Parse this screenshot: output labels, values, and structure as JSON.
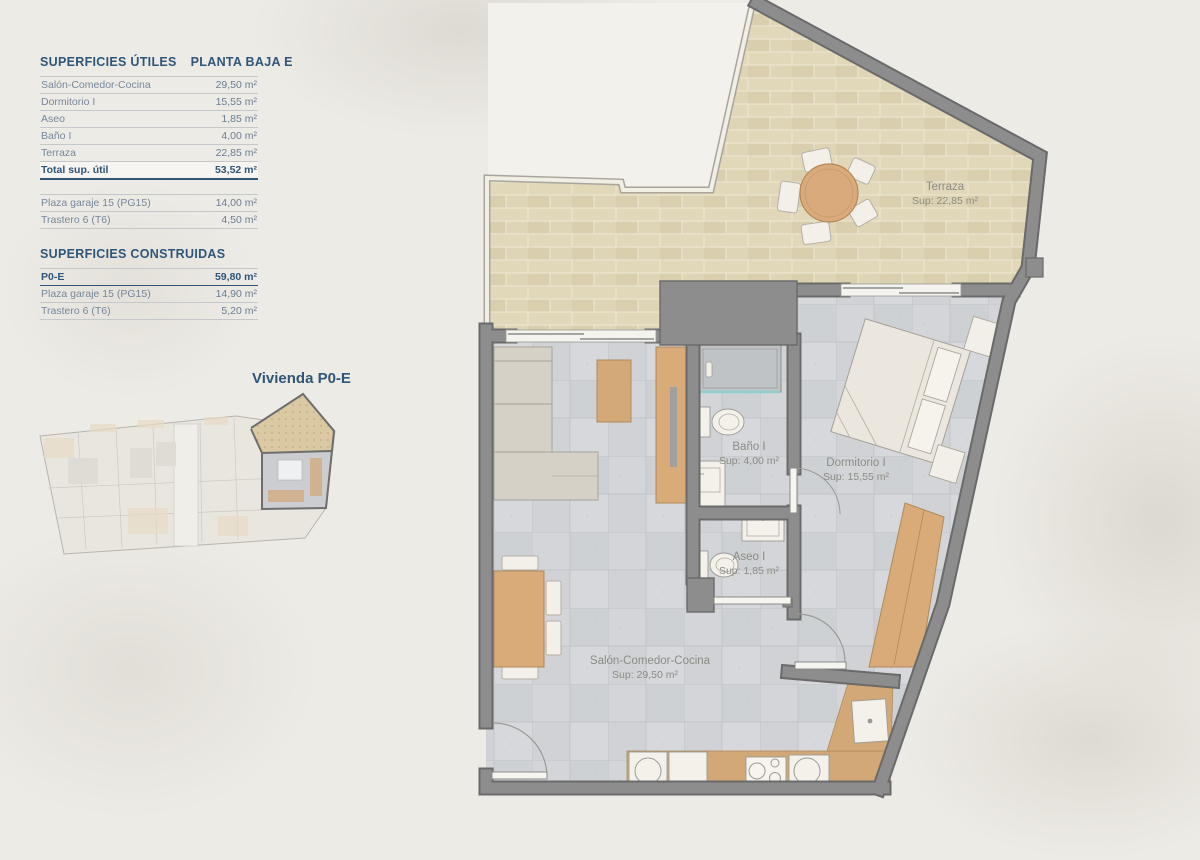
{
  "panel": {
    "header": {
      "left": "SUPERFICIES ÚTILES",
      "right": "PLANTA BAJA E"
    },
    "useful": [
      {
        "label": "Salón-Comedor-Cocina",
        "value": "29,50 m²"
      },
      {
        "label": "Dormitorio I",
        "value": "15,55 m²"
      },
      {
        "label": "Aseo",
        "value": "1,85 m²"
      },
      {
        "label": "Baño I",
        "value": "4,00 m²"
      },
      {
        "label": "Terraza",
        "value": "22,85 m²"
      }
    ],
    "total": {
      "label": "Total sup. útil",
      "value": "53,52 m²"
    },
    "annex": [
      {
        "label": "Plaza garaje 15 (PG15)",
        "value": "14,00 m²"
      },
      {
        "label": "Trastero 6 (T6)",
        "value": "4,50 m²"
      }
    ],
    "constructed_title": "SUPERFICIES CONSTRUIDAS",
    "constructed": [
      {
        "label": "P0-E",
        "value": "59,80 m²"
      },
      {
        "label": "Plaza garaje 15 (PG15)",
        "value": "14,90 m²"
      },
      {
        "label": "Trastero 6 (T6)",
        "value": "5,20 m²"
      }
    ],
    "keyplan_label": "Vivienda P0-E"
  },
  "plan": {
    "terraza": {
      "name": "Terraza",
      "area": "Sup: 22,85 m²"
    },
    "dormitorio": {
      "name": "Dormitorio I",
      "area": "Sup: 15,55 m²"
    },
    "bano": {
      "name": "Baño I",
      "area": "Sup: 4,00 m²"
    },
    "aseo": {
      "name": "Aseo I",
      "area": "Sup: 1,85 m²"
    },
    "salon": {
      "name": "Salón-Comedor-Cocina",
      "area": "Sup: 29,50 m²"
    }
  },
  "colors": {
    "accent_blue": "#2f5578",
    "wall_gray": "#8d8d8d",
    "wood": "#d8ab79",
    "terrace_tan": "#ddd2b1",
    "floor_gray": "#d3d5d8",
    "label_gray": "#8b8b85"
  }
}
